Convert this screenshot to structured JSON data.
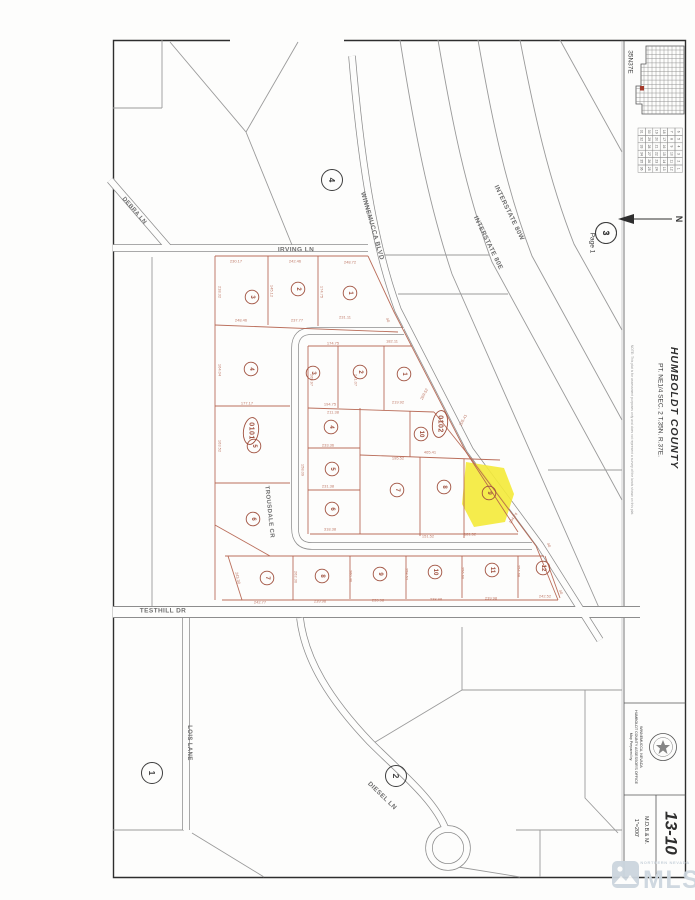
{
  "document": {
    "township_label": "35N37E",
    "page_ref": {
      "number": "3",
      "label": "Page 1"
    },
    "north_label": "N",
    "county": "HUMBOLDT COUNTY",
    "legal_description": "PT. NE1/4 SEC. 2 T.35N. R.37E.",
    "note": "NOTE: This plat is for assessment purposes only and does not represent a survey of the lands shown on this plat.",
    "prepared_by": [
      "Map Prepared by:",
      "HUMBOLDT COUNTY ASSESSOR'S OFFICE",
      "WINNEMUCCA, NEVADA"
    ],
    "map_number": "13-10",
    "scale": "1\"=200'",
    "meridian": "M.D.B.& M."
  },
  "watermark": {
    "brand": "MLS",
    "tagline": "NORTHERN NEVADA"
  },
  "section_grid": {
    "display_rows": [
      [
        "31",
        "30",
        "19",
        "18",
        "7",
        "6"
      ],
      [
        "32",
        "29",
        "20",
        "17",
        "8",
        "5"
      ],
      [
        "33",
        "28",
        "21",
        "16",
        "9",
        "4"
      ],
      [
        "34",
        "27",
        "22",
        "15",
        "10",
        "3"
      ],
      [
        "35",
        "26",
        "23",
        "14",
        "11",
        "2"
      ],
      [
        "36",
        "25",
        "24",
        "13",
        "12",
        "1"
      ]
    ],
    "highlight": "2"
  },
  "map": {
    "street_labels": [
      {
        "text": "IRVING LN",
        "x": 296,
        "y": 250,
        "r": 0,
        "s": 6.5
      },
      {
        "text": "DEBRA LN",
        "x": 134,
        "y": 211,
        "r": 49,
        "s": 6
      },
      {
        "text": "WINNEMUCCA BLVD",
        "x": 372,
        "y": 226,
        "r": 74,
        "s": 6.5
      },
      {
        "text": "INTERSTATE 80W",
        "x": 509,
        "y": 213,
        "r": 64,
        "s": 6.5
      },
      {
        "text": "INTERSTATE 80E",
        "x": 488,
        "y": 243,
        "r": 64,
        "s": 6.5
      },
      {
        "text": "TROUSDALE CR",
        "x": 269,
        "y": 512,
        "r": 84,
        "s": 6
      },
      {
        "text": "TESTHILL DR",
        "x": 163,
        "y": 611,
        "r": 0,
        "s": 6.5
      },
      {
        "text": "LOIS LANE",
        "x": 189,
        "y": 743,
        "r": 90,
        "s": 6
      },
      {
        "text": "DIESEL LN",
        "x": 382,
        "y": 796,
        "r": 44,
        "s": 6.5
      }
    ],
    "area_numbers": [
      {
        "n": "4",
        "x": 332,
        "y": 180
      },
      {
        "n": "3",
        "x": 606,
        "y": 233
      },
      {
        "n": "1",
        "x": 152,
        "y": 773
      },
      {
        "n": "2",
        "x": 396,
        "y": 776
      }
    ],
    "block_labels": [
      {
        "text": "0101",
        "x": 251,
        "y": 431
      },
      {
        "text": "0102",
        "x": 440,
        "y": 424
      }
    ],
    "lot_numbers": [
      {
        "n": "3",
        "x": 252,
        "y": 297
      },
      {
        "n": "2",
        "x": 298,
        "y": 289
      },
      {
        "n": "1",
        "x": 350,
        "y": 293
      },
      {
        "n": "4",
        "x": 251,
        "y": 369
      },
      {
        "n": "5",
        "x": 254,
        "y": 446
      },
      {
        "n": "6",
        "x": 253,
        "y": 519
      },
      {
        "n": "7",
        "x": 267,
        "y": 578
      },
      {
        "n": "8",
        "x": 322,
        "y": 576
      },
      {
        "n": "9",
        "x": 380,
        "y": 574
      },
      {
        "n": "10",
        "x": 435,
        "y": 572
      },
      {
        "n": "11",
        "x": 492,
        "y": 570
      },
      {
        "n": "12",
        "x": 543,
        "y": 568
      },
      {
        "n": "3",
        "x": 313,
        "y": 373
      },
      {
        "n": "2",
        "x": 360,
        "y": 372
      },
      {
        "n": "1",
        "x": 404,
        "y": 374
      },
      {
        "n": "4",
        "x": 331,
        "y": 427
      },
      {
        "n": "5",
        "x": 332,
        "y": 469
      },
      {
        "n": "6",
        "x": 332,
        "y": 509
      },
      {
        "n": "10",
        "x": 421,
        "y": 434
      },
      {
        "n": "7",
        "x": 397,
        "y": 490
      },
      {
        "n": "8",
        "x": 444,
        "y": 487
      }
    ],
    "highlight_lot": {
      "n": "9",
      "x": 489,
      "y": 493
    },
    "dimensions": [
      {
        "t": "230.17",
        "x": 236,
        "y": 261,
        "r": 0
      },
      {
        "t": "242.46",
        "x": 295,
        "y": 261,
        "r": 0
      },
      {
        "t": "248.72",
        "x": 350,
        "y": 262,
        "r": 0
      },
      {
        "t": "218.32",
        "x": 220,
        "y": 292,
        "r": 90
      },
      {
        "t": "145.12",
        "x": 272,
        "y": 291,
        "r": 90
      },
      {
        "t": "174.75",
        "x": 322,
        "y": 292,
        "r": 90
      },
      {
        "t": "248.46",
        "x": 241,
        "y": 320,
        "r": 0
      },
      {
        "t": "237.77",
        "x": 297,
        "y": 320,
        "r": 0
      },
      {
        "t": "231.11",
        "x": 345,
        "y": 317,
        "r": 0
      },
      {
        "t": "174.75",
        "x": 333,
        "y": 343,
        "r": 0
      },
      {
        "t": "182.11",
        "x": 392,
        "y": 341,
        "r": 0
      },
      {
        "t": "265.97",
        "x": 312,
        "y": 380,
        "r": 90
      },
      {
        "t": "241.07",
        "x": 356,
        "y": 380,
        "r": 90
      },
      {
        "t": "177.17",
        "x": 247,
        "y": 403,
        "r": 0
      },
      {
        "t": "194.75",
        "x": 330,
        "y": 404,
        "r": 0
      },
      {
        "t": "219.92",
        "x": 398,
        "y": 402,
        "r": 0
      },
      {
        "t": "269.52",
        "x": 424,
        "y": 394,
        "r": -62
      },
      {
        "t": "205.41",
        "x": 463,
        "y": 420,
        "r": -62
      },
      {
        "t": "211.38",
        "x": 333,
        "y": 412,
        "r": 0
      },
      {
        "t": "233.36",
        "x": 328,
        "y": 445,
        "r": 0
      },
      {
        "t": "465.41",
        "x": 430,
        "y": 452,
        "r": 0
      },
      {
        "t": "164.04",
        "x": 220,
        "y": 370,
        "r": 90
      },
      {
        "t": "163.52",
        "x": 220,
        "y": 446,
        "r": 90
      },
      {
        "t": "231.38",
        "x": 328,
        "y": 486,
        "r": 0
      },
      {
        "t": "158.09",
        "x": 303,
        "y": 470,
        "r": 90
      },
      {
        "t": "318.38",
        "x": 330,
        "y": 529,
        "r": 0
      },
      {
        "t": "195.52",
        "x": 398,
        "y": 458,
        "r": 0
      },
      {
        "t": "151.52",
        "x": 428,
        "y": 536,
        "r": 0
      },
      {
        "t": "181.52",
        "x": 470,
        "y": 534,
        "r": 0
      },
      {
        "t": "134.74",
        "x": 513,
        "y": 518,
        "r": -55
      },
      {
        "t": "242.77",
        "x": 260,
        "y": 602,
        "r": 0
      },
      {
        "t": "239.98",
        "x": 320,
        "y": 601,
        "r": 0
      },
      {
        "t": "239.98",
        "x": 378,
        "y": 600,
        "r": 0
      },
      {
        "t": "238.98",
        "x": 436,
        "y": 599,
        "r": 0
      },
      {
        "t": "239.98",
        "x": 491,
        "y": 598,
        "r": 0
      },
      {
        "t": "242.52",
        "x": 545,
        "y": 596,
        "r": 0
      },
      {
        "t": "262.30",
        "x": 296,
        "y": 577,
        "r": 90
      },
      {
        "t": "260.40",
        "x": 351,
        "y": 576,
        "r": 90
      },
      {
        "t": "258.52",
        "x": 407,
        "y": 574,
        "r": 90
      },
      {
        "t": "256.60",
        "x": 463,
        "y": 573,
        "r": 90
      },
      {
        "t": "254.68",
        "x": 519,
        "y": 571,
        "r": 90
      },
      {
        "t": "243.30",
        "x": 238,
        "y": 578,
        "r": 78
      }
    ],
    "row_markers": [
      {
        "t": "40",
        "x": 388,
        "y": 320,
        "r": 70
      },
      {
        "t": "40",
        "x": 549,
        "y": 545,
        "r": 70
      },
      {
        "t": "40",
        "x": 561,
        "y": 592,
        "r": 70
      }
    ]
  }
}
